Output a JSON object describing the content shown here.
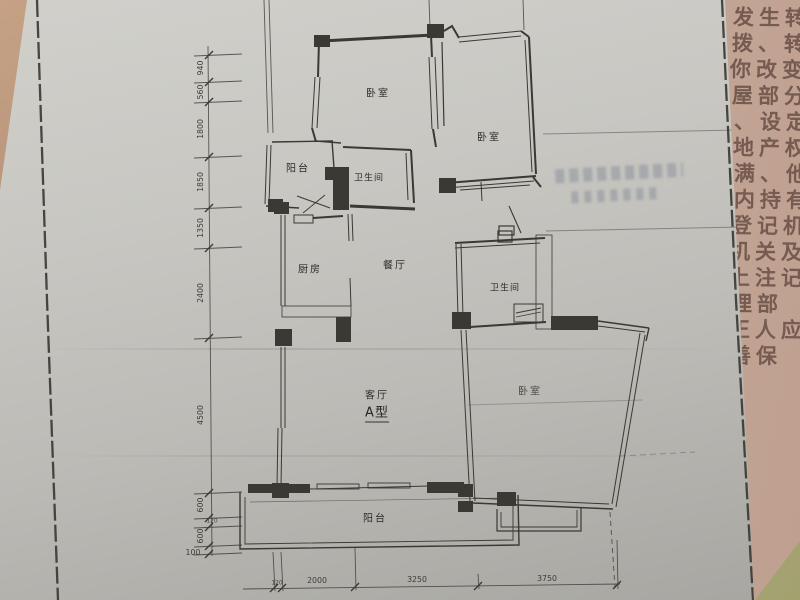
{
  "plan": {
    "type_label": "A型",
    "rooms": [
      {
        "id": "bedroom-top-left",
        "label": "卧室"
      },
      {
        "id": "bedroom-top-right",
        "label": "卧室"
      },
      {
        "id": "balcony-top",
        "label": "阳台"
      },
      {
        "id": "bathroom-top",
        "label": "卫生间"
      },
      {
        "id": "kitchen",
        "label": "厨房"
      },
      {
        "id": "dining-room",
        "label": "餐厅"
      },
      {
        "id": "bathroom-middle",
        "label": "卫生间"
      },
      {
        "id": "living-room",
        "label": "客厅"
      },
      {
        "id": "bedroom-bottom",
        "label": "卧室"
      },
      {
        "id": "balcony-bottom",
        "label": "阳台"
      }
    ],
    "dims_left": [
      "940",
      "560",
      "1800",
      "1850",
      "1350",
      "2400",
      "4500",
      "600",
      "120",
      "600",
      "100"
    ],
    "dims_bottom": [
      "120",
      "2000",
      "3250",
      "3750"
    ]
  },
  "side_document": {
    "lines": [
      "发生转移",
      "拨、转让",
      "你改变或",
      "屋部分",
      "、设定",
      "地产权",
      "满、他",
      "内持有",
      "登记机",
      "机关及",
      "上注记",
      "理部",
      "正人应",
      "善保"
    ]
  },
  "colors": {
    "ink": "#3b3934",
    "side_text": "#6a5147",
    "stamp": "#878d99",
    "pink_paper": "#c9ad9e",
    "green_corner": "#a8a877"
  }
}
